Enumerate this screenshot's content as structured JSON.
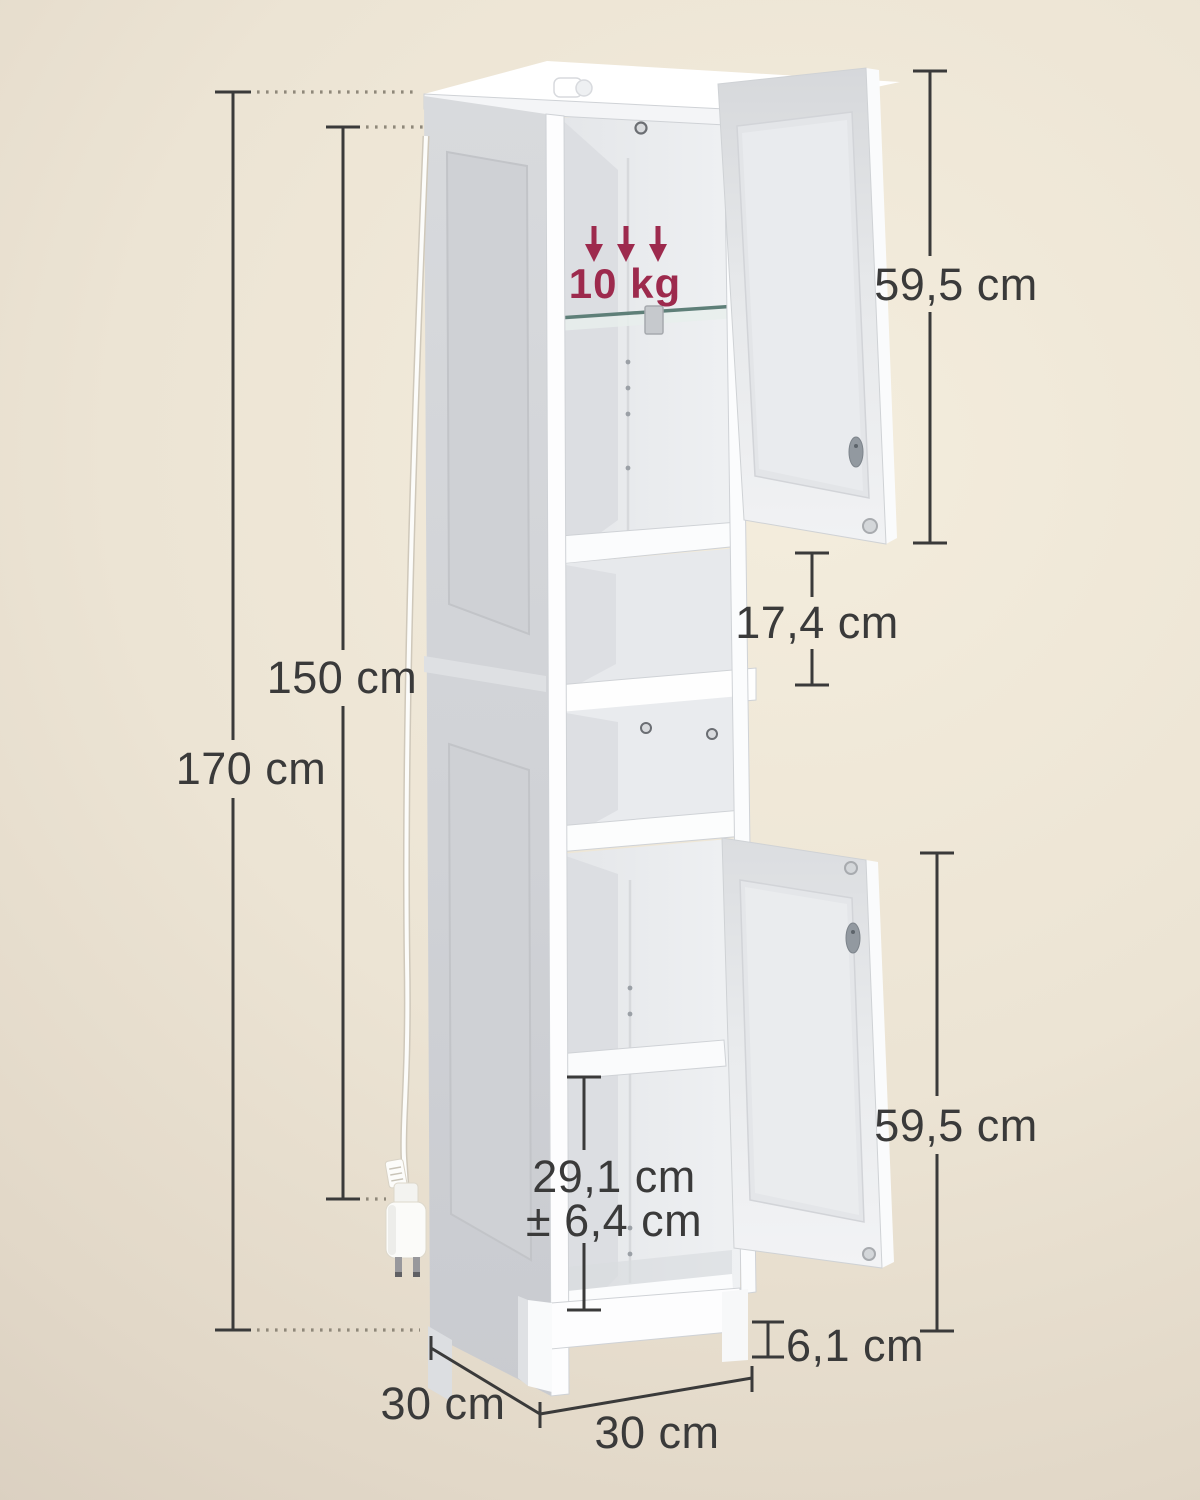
{
  "annotations": {
    "load_capacity": "10 kg",
    "total_height": "170 cm",
    "body_height": "150 cm",
    "upper_door_height": "59,5 cm",
    "open_compartment_height": "17,4 cm",
    "lower_door_height": "59,5 cm",
    "shelf_clearance": "29,1 cm",
    "shelf_clearance_tolerance": "± 6,4 cm",
    "foot_height": "6,1 cm",
    "depth": "30 cm",
    "width": "30 cm"
  },
  "colors": {
    "background_center": "#f4eddd",
    "background_edge": "#d7ccbd",
    "accent_red": "#9d2a4d",
    "dimension_line": "#3a3a3a",
    "dotted_leader": "#8f887a",
    "cabinet_white": "#ffffff",
    "cabinet_side_gray": "#d2d4d7",
    "interior_gray": "#e9ebee"
  }
}
